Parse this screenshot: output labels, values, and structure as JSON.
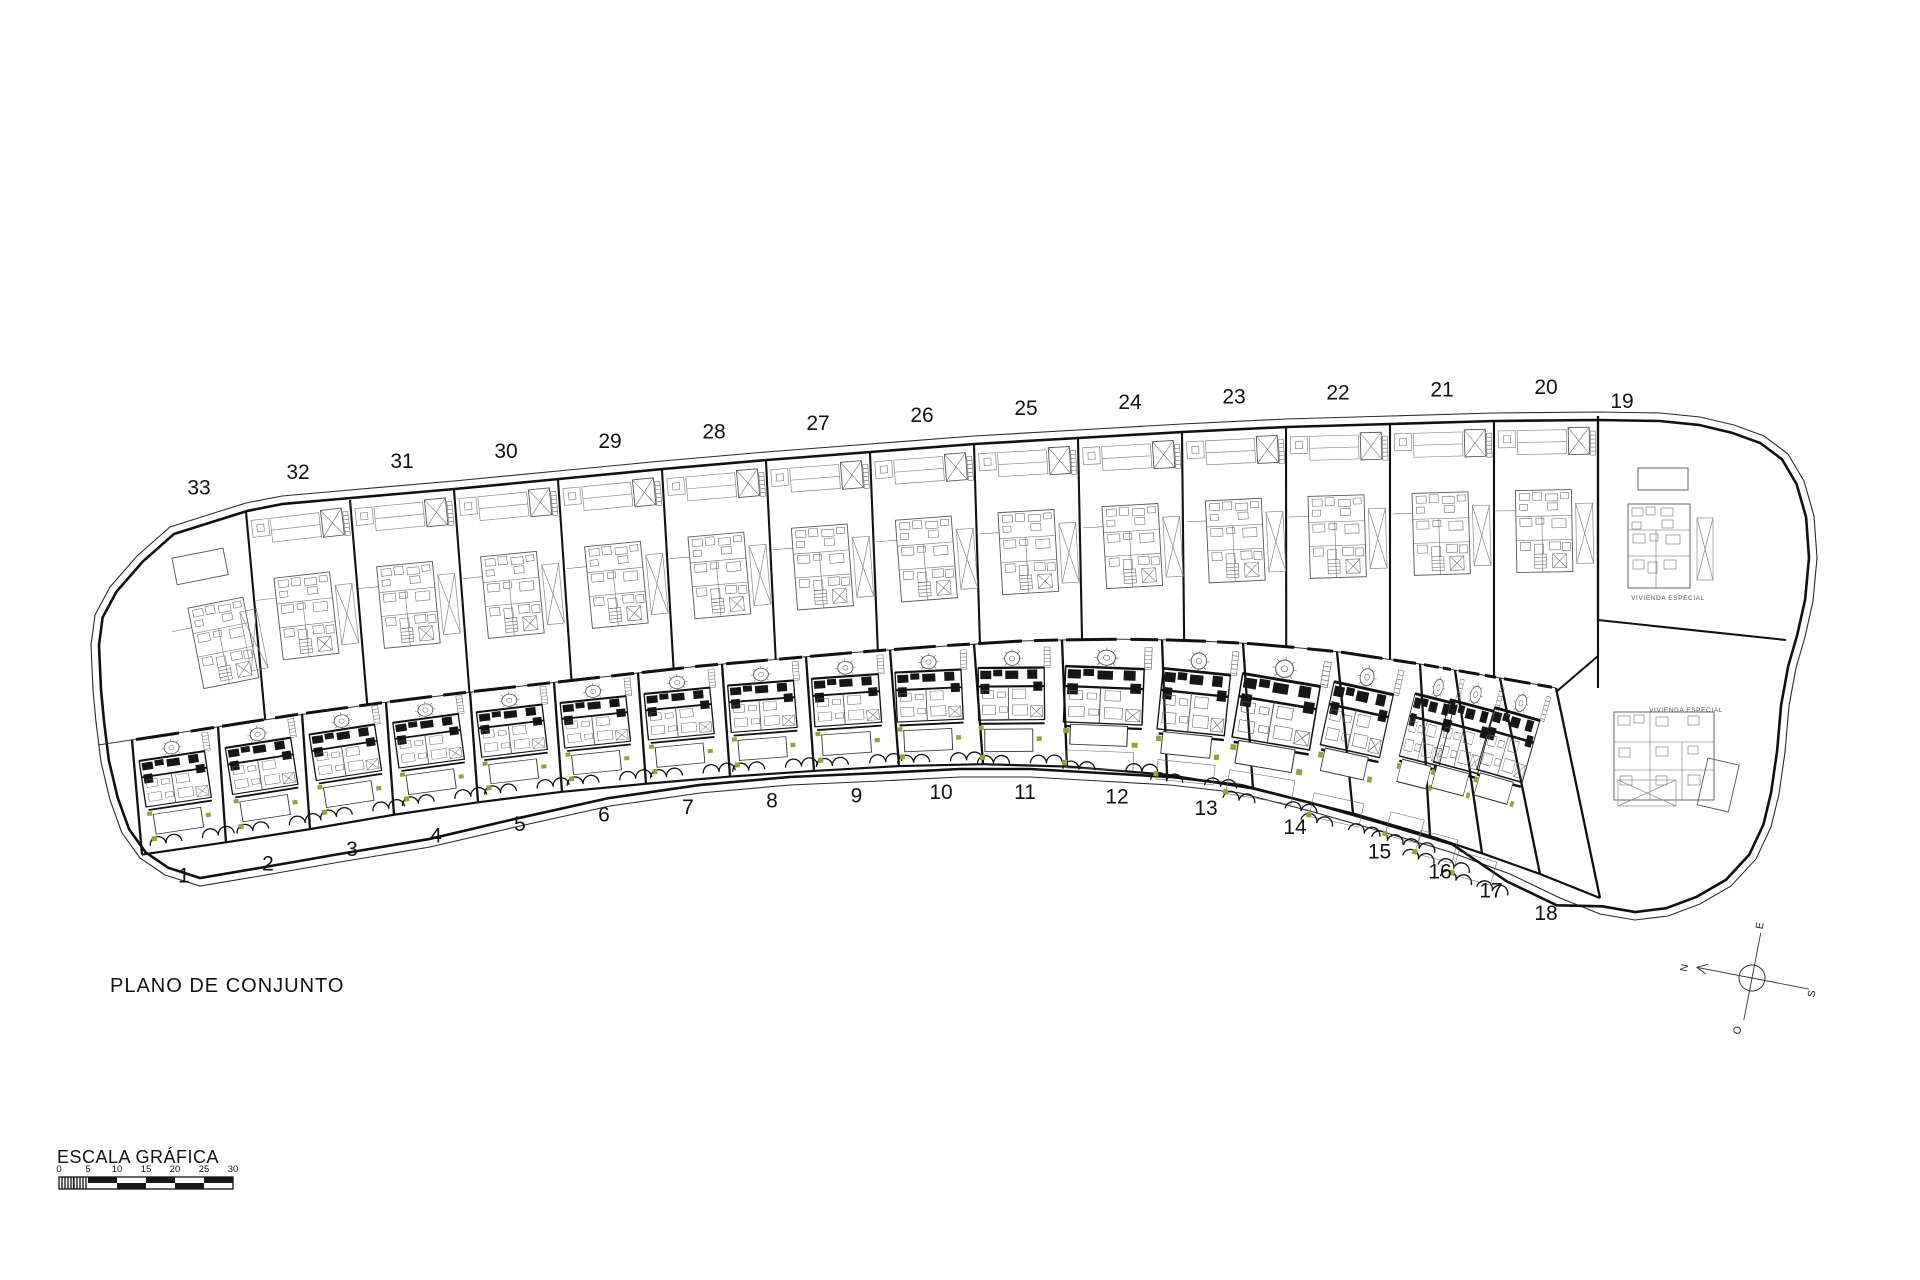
{
  "drawing": {
    "title": "PLANO DE CONJUNTO",
    "scale": {
      "label": "ESCALA GRÁFICA",
      "ticks": [
        "0",
        "5",
        "10",
        "15",
        "20",
        "25",
        "30"
      ]
    },
    "compass": {
      "north": "N",
      "south": "S",
      "east": "E",
      "west": "O"
    },
    "special_label": "VIVIENDA ESPECIAL",
    "top_row_plots": [
      "33",
      "32",
      "31",
      "30",
      "29",
      "28",
      "27",
      "26",
      "25",
      "24",
      "23",
      "22",
      "21",
      "20"
    ],
    "corner_plot": "19",
    "bottom_row_plots": [
      "1",
      "2",
      "3",
      "4",
      "5",
      "6",
      "7",
      "8",
      "9",
      "10",
      "11",
      "12",
      "13",
      "14",
      "15",
      "16",
      "17",
      "18"
    ],
    "colors": {
      "line": "#1a1a1a",
      "light_line": "#8a8a8a",
      "green": "#96a037",
      "paper": "#ffffff"
    }
  }
}
